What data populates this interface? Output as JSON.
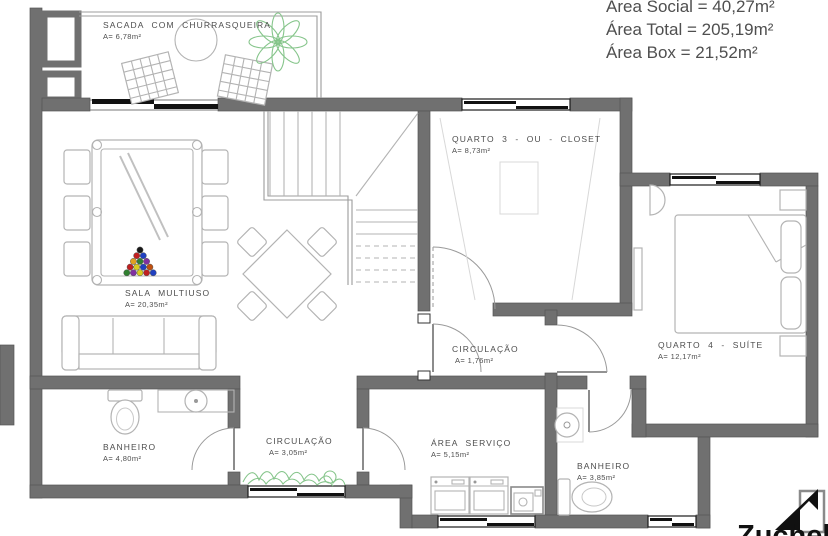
{
  "info_panel": {
    "lines": [
      "Área Social = 40,27m²",
      "Área Total = 205,19m²",
      "Área Box = 21,52m²"
    ]
  },
  "rooms": {
    "sacada": {
      "name": "SACADA COM CHURRASQUEIRA",
      "area": "A= 6,78m²"
    },
    "sala": {
      "name": "SALA MULTIUSO",
      "area": "A= 20,35m²"
    },
    "quarto3": {
      "name": "QUARTO 3 - OU - CLOSET",
      "area": "A= 8,73m²"
    },
    "quarto4": {
      "name": "QUARTO 4 - SUÍTE",
      "area": "A= 12,17m²"
    },
    "circulacao1": {
      "name": "CIRCULAÇÃO",
      "area": "A= 1,76m²"
    },
    "circulacao2": {
      "name": "CIRCULAÇÃO",
      "area": "A= 3,05m²"
    },
    "banheiro1": {
      "name": "BANHEIRO",
      "area": "A= 4,80m²"
    },
    "servico": {
      "name": "ÁREA SERVIÇO",
      "area": "A= 5,15m²"
    },
    "banheiro2": {
      "name": "BANHEIRO",
      "area": "A= 3,85m²"
    }
  },
  "logo": {
    "wordmark": "Zuchel"
  },
  "colors": {
    "wall": "#707070",
    "furniture_outline": "#b3b3b3",
    "label_text": "#4d4d4d",
    "info_text": "#4f4f4f",
    "plant_green": "#86c58b",
    "window_frame": "#1a1a1a"
  }
}
